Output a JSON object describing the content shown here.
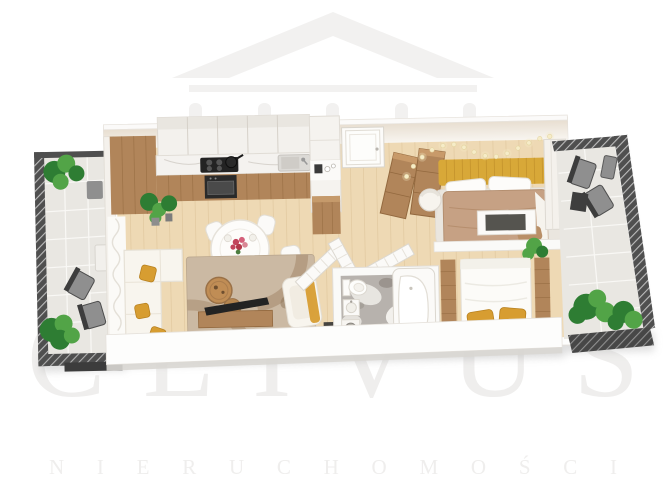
{
  "watermark": {
    "brand": "CLIVUS",
    "subtitle": "NIERUCHOMOŚCI"
  },
  "logo": {
    "icon": "house-roof-with-columns-icon"
  },
  "colors": {
    "background": "#ffffff",
    "watermark_gray": "#f2f1f0",
    "watermark_text": "#efeeed",
    "wall_white": "#fdfdfc",
    "wall_shade": "#e7e3dd",
    "floor_wood": "#eed9b4",
    "floor_wood_line": "#dfc69c",
    "cabinet_wood": "#b1855a",
    "cabinet_wood_dark": "#93693f",
    "counter_marble": "#f4f2ef",
    "appliance_black": "#232323",
    "sofa_white": "#f8f5ee",
    "accent_mustard": "#d79d31",
    "headboard_yellow": "#d8a838",
    "bed_tan": "#c6a184",
    "rug_beige": "#cbb9a3",
    "rug_pattern": "#a08263",
    "bath_marble": "#b7b2ad",
    "tile_light": "#e9e7e2",
    "railing_dark": "#4f4f4f",
    "plant_green": "#2e7d33",
    "plant_green_light": "#52a447",
    "furniture_gray": "#8f8f8f",
    "string_light": "#f6ecc8"
  },
  "scene": {
    "type": "3d-floor-plan-render",
    "rooms": [
      {
        "id": "balcony-left",
        "furniture": [
          "railing",
          "potted-plants",
          "outdoor-chairs",
          "side-table",
          "doormat"
        ]
      },
      {
        "id": "kitchen",
        "furniture": [
          "tall-cabinet",
          "upper-cabinets",
          "marble-counter",
          "cooktop-with-pot",
          "oven",
          "sink",
          "potted-plants"
        ]
      },
      {
        "id": "dining-area",
        "furniture": [
          "round-table",
          "chairs",
          "flower-bouquet",
          "plates"
        ]
      },
      {
        "id": "living-room",
        "furniture": [
          "corner-sofa",
          "mustard-pillows",
          "area-rug",
          "round-coffee-tables",
          "tv-on-stand",
          "armchair",
          "curtain"
        ]
      },
      {
        "id": "hallway",
        "furniture": [
          "entrance-door",
          "wooden-wardrobes",
          "louver-doors",
          "coffee-cabinet",
          "dark-mat"
        ]
      },
      {
        "id": "bathroom",
        "furniture": [
          "toilet",
          "washbasin",
          "corner-bathtub",
          "washer",
          "marble-floor"
        ]
      },
      {
        "id": "bedroom-main",
        "furniture": [
          "yellow-headboard-bed",
          "string-lights",
          "barrel-chair",
          "rug",
          "desk",
          "wardrobe",
          "nightstand",
          "plant"
        ]
      },
      {
        "id": "bedroom-second",
        "furniture": [
          "bed-with-yellow-pillows",
          "wooden-side-benches"
        ]
      },
      {
        "id": "balcony-right",
        "furniture": [
          "railing",
          "outdoor-lounge-set",
          "potted-bushes",
          "planter"
        ]
      }
    ]
  }
}
